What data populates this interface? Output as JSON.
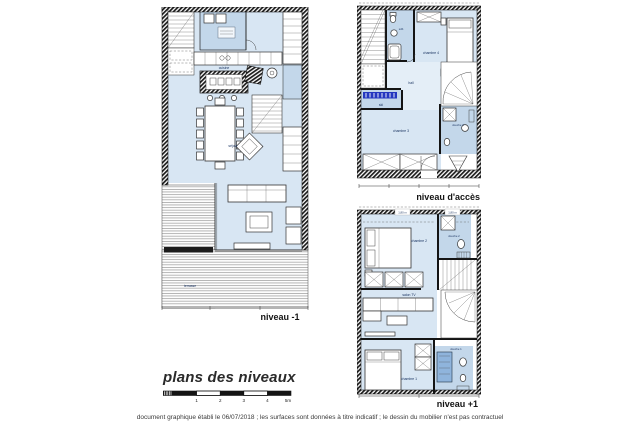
{
  "document": {
    "title": "plans des niveaux",
    "footer_note": "document graphique établi le 06/07/2018 ; les surfaces sont données à titre indicatif ; le dessin du mobilier n'est pas contractuel"
  },
  "scale_bar": {
    "labels": [
      "1",
      "2",
      "3",
      "4",
      "5m"
    ]
  },
  "colors": {
    "room_fill": "#d8e6f3",
    "wet_room_fill": "#c3d7ea",
    "hall_fill": "#e4eef7",
    "ski_rack_blue": "#2438c0",
    "shower_fill": "#8fb4dc",
    "wall": "#141414",
    "deck_line": "#9b9b9b"
  },
  "plans": [
    {
      "label": "niveau -1",
      "rooms": {
        "kitchen": "cuisine",
        "living": "séjour",
        "terrace": "terrasse"
      }
    },
    {
      "label": "niveau d'accès",
      "rooms": {
        "bathroom": "sdb",
        "bedroom4": "chambre 4",
        "hall": "hall",
        "ski": "ski",
        "bedroom3": "chambre 3",
        "shower3": "douche 3"
      }
    },
    {
      "label": "niveau +1",
      "rooms": {
        "bedroom2": "chambre 2",
        "shower2": "douche 2",
        "tv_lounge": "salon TV",
        "bedroom1": "chambre 1",
        "shower1": "douche 1",
        "height1": "1,80 m",
        "height2": "1,80 m"
      }
    }
  ]
}
